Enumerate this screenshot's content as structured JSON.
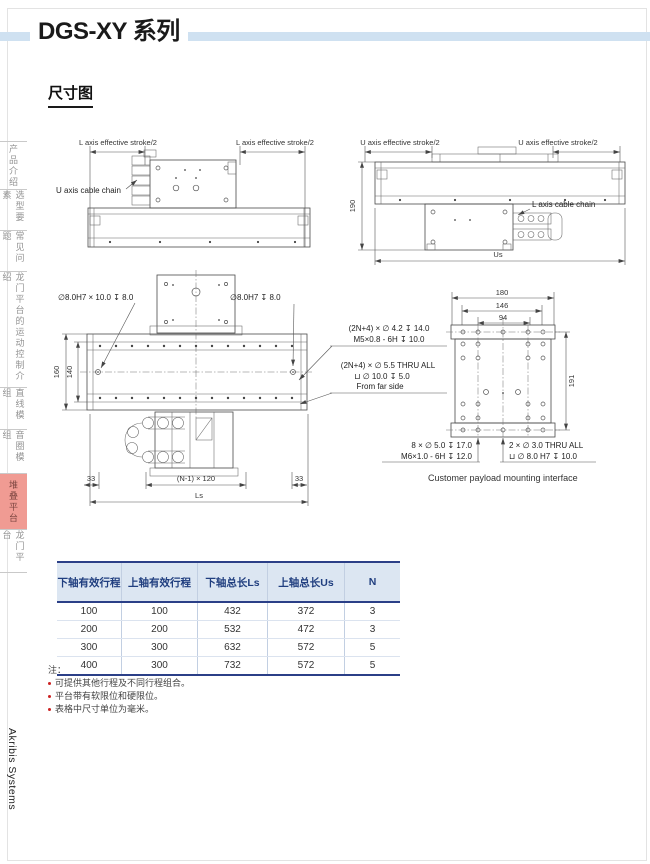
{
  "page": {
    "title": "DGS-XY 系列",
    "section_heading": "尺寸图",
    "brand": "Akribis Systems"
  },
  "colors": {
    "accent_bar": "#cfe1f1",
    "active_tab_bg": "#f09b93",
    "table_header_bg": "#dce6f2",
    "table_header_text": "#203e7f",
    "table_border": "#2b3f87",
    "note_bullet": "#cc2222"
  },
  "sidebar": {
    "items": [
      {
        "label": "产品介绍",
        "active": false
      },
      {
        "label": "选型要素",
        "active": false
      },
      {
        "label": "常见问题",
        "active": false
      },
      {
        "label": "龙门平台的运动控制介绍",
        "active": false
      },
      {
        "label": "直线模组",
        "active": false
      },
      {
        "label": "音圈模组",
        "active": false
      },
      {
        "label": "堆叠平台",
        "active": true
      },
      {
        "label": "龙门平台",
        "active": false
      }
    ]
  },
  "drawings": {
    "side_view_l": {
      "stroke_left": "L axis effective stroke/2",
      "stroke_right": "L axis effective stroke/2",
      "cable_chain": "U axis cable chain"
    },
    "side_view_u": {
      "stroke_left": "U axis effective stroke/2",
      "stroke_right": "U axis effective stroke/2",
      "height": "190",
      "cable_chain": "L axis cable chain",
      "total": "Us"
    },
    "plan_view": {
      "pin_left": "∅8.0H7 × 10.0 ↧ 8.0",
      "pin_right": "∅8.0H7 ↧ 8.0",
      "dim_outer": "160",
      "dim_inner": "140",
      "dim_margin_left": "33",
      "dim_pitch": "(N-1) × 120",
      "dim_margin_right": "33",
      "dim_total": "Ls",
      "tapped_line1": "(2N+4) × ∅ 4.2 ↧ 14.0",
      "tapped_line2": "M5×0.8 - 6H ↧ 10.0",
      "thru_line1": "(2N+4) × ∅ 5.5 THRU ALL",
      "thru_line2": "⊔ ∅ 10.0 ↧ 5.0",
      "thru_line3": "From far side"
    },
    "payload": {
      "dim_180": "180",
      "dim_146": "146",
      "dim_94": "94",
      "dim_191": "191",
      "left_line1": "8 × ∅ 5.0 ↧ 17.0",
      "left_line2": "M6×1.0 - 6H ↧ 12.0",
      "right_line1": "2 × ∅ 3.0 THRU ALL",
      "right_line2": "⊔ ∅ 8.0 H7 ↧ 10.0",
      "caption": "Customer payload mounting interface"
    }
  },
  "table": {
    "headers": [
      "下轴有效行程",
      "上轴有效行程",
      "下轴总长Ls",
      "上轴总长Us",
      "N"
    ],
    "rows": [
      [
        "100",
        "100",
        "432",
        "372",
        "3"
      ],
      [
        "200",
        "200",
        "532",
        "472",
        "3"
      ],
      [
        "300",
        "300",
        "632",
        "572",
        "5"
      ],
      [
        "400",
        "300",
        "732",
        "572",
        "5"
      ]
    ]
  },
  "notes": {
    "title": "注：",
    "items": [
      "可提供其他行程及不同行程组合。",
      "平台带有软限位和硬限位。",
      "表格中尺寸单位为毫米。"
    ]
  }
}
